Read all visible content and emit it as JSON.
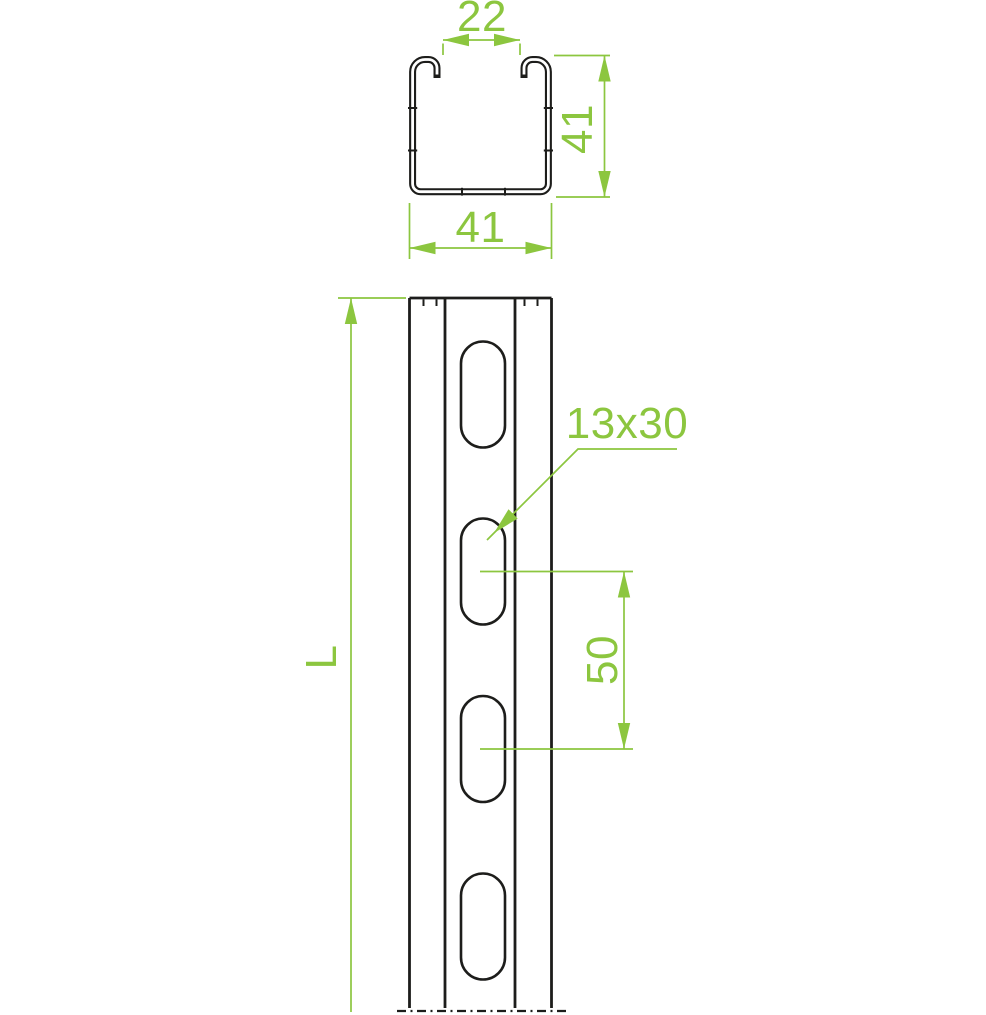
{
  "colors": {
    "outline": "#1d1d1b",
    "dimension": "#8cc63f",
    "background": "#ffffff"
  },
  "cross_section_view": {
    "dim_opening_width": "22",
    "dim_height": "41",
    "dim_width": "41"
  },
  "front_view": {
    "dim_length": "L",
    "dim_slot_size": "13x30",
    "dim_slot_spacing": "50"
  }
}
